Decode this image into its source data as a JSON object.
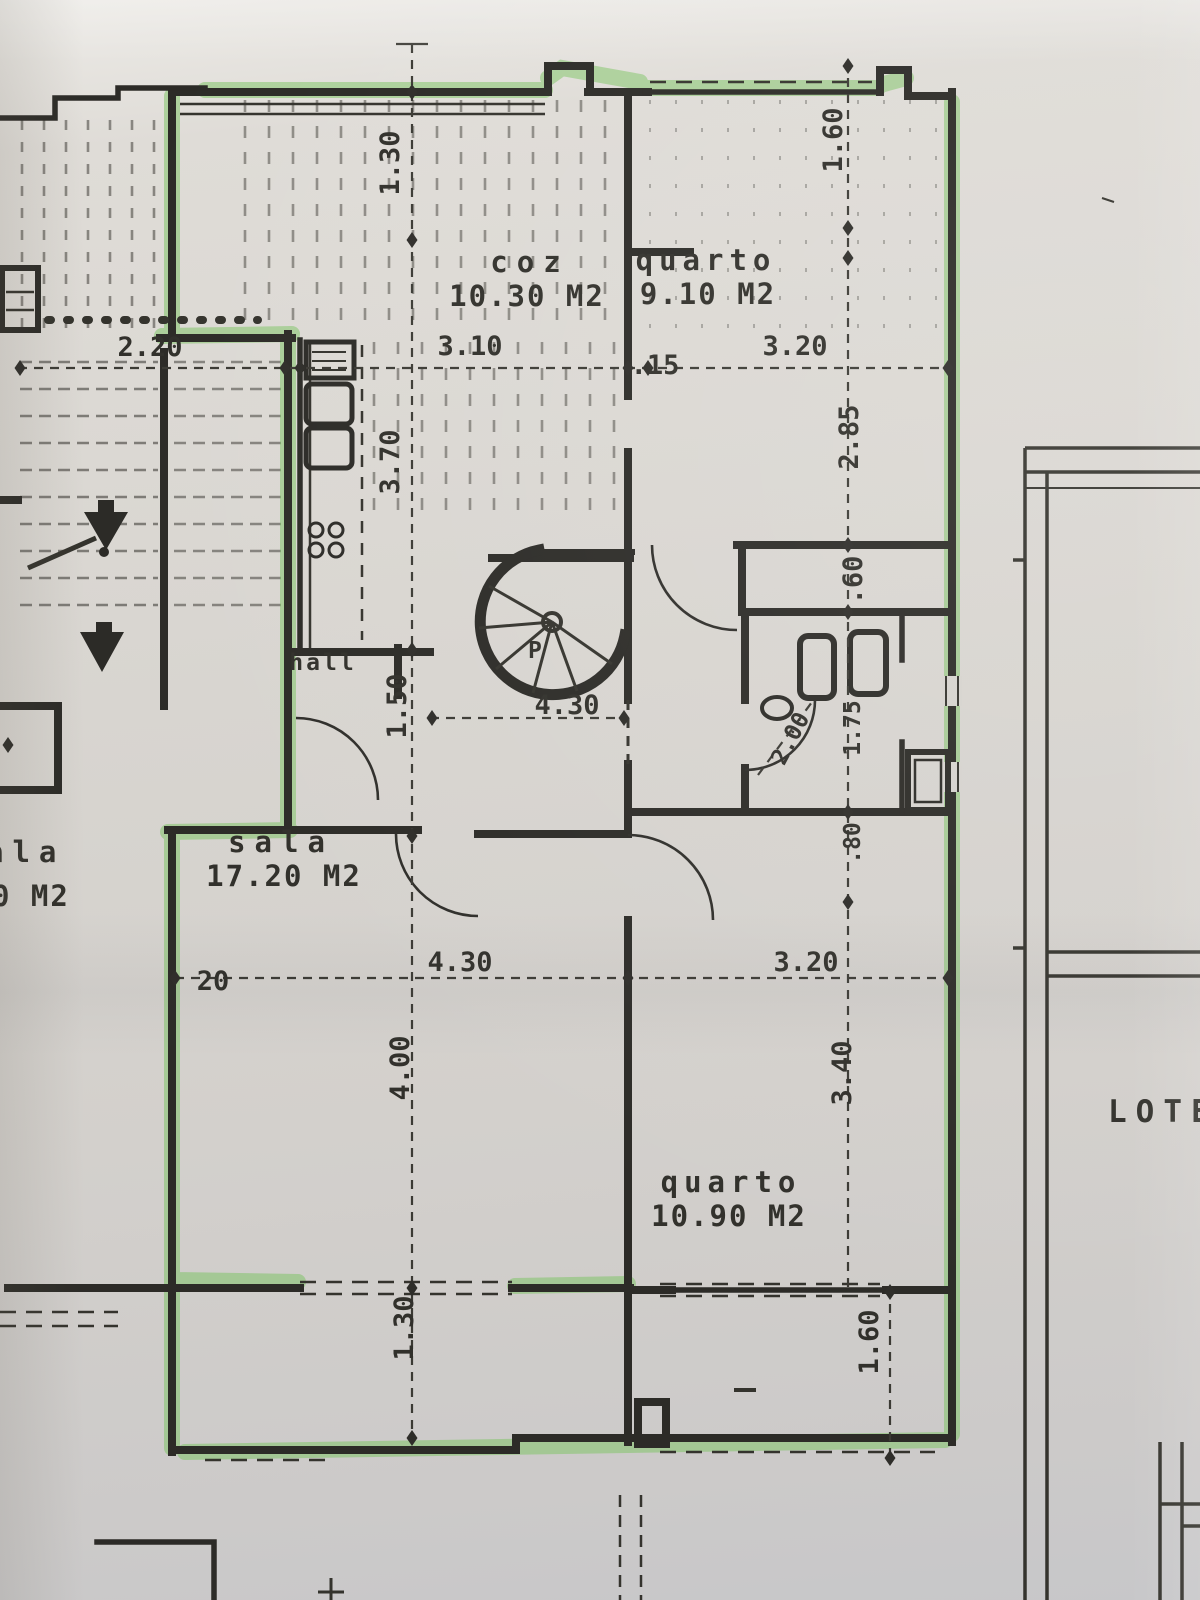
{
  "document": {
    "kind": "highlighted floor plan photo",
    "highlight_color": "#7cc463",
    "ink_color": "#2c2b27",
    "paper_color": "#d8d5d0"
  },
  "rooms": {
    "coz": {
      "label": "coz",
      "area": "10.30 M2"
    },
    "quarto_top": {
      "label": "quarto",
      "area": "9.10 M2"
    },
    "hall": {
      "label": "hall"
    },
    "sala": {
      "label": "sala",
      "area": "17.20 M2"
    },
    "quarto_bottom": {
      "label": "quarto",
      "area": "10.90 M2"
    },
    "neighbor": {
      "label_fragment": "ala",
      "area_fragment": "0 M2"
    }
  },
  "stair": {
    "letter": "P"
  },
  "site": {
    "lote_label": "LOTE"
  },
  "dims": {
    "balcony_top": "1.30",
    "stair_width": "2.20",
    "coz_width": "3.10",
    "wall_15": ".15",
    "quarto_top_width": "3.20",
    "terrace_right": "1.60",
    "coz_depth": "3.70",
    "quarto_top_depth": "2.85",
    "closet_60": ".60",
    "hall_width": "1.50",
    "hall_length": "4.30",
    "bath_diag": "2.00",
    "bath_depth": "1.75",
    "rec_80": ".80",
    "wall_20": "20",
    "sala_width": "4.30",
    "sala_depth": "4.00",
    "quarto_b_width": "3.20",
    "quarto_b_depth": "3.40",
    "balcony_bottom": "1.30",
    "terrace_bottom": "1.60"
  }
}
